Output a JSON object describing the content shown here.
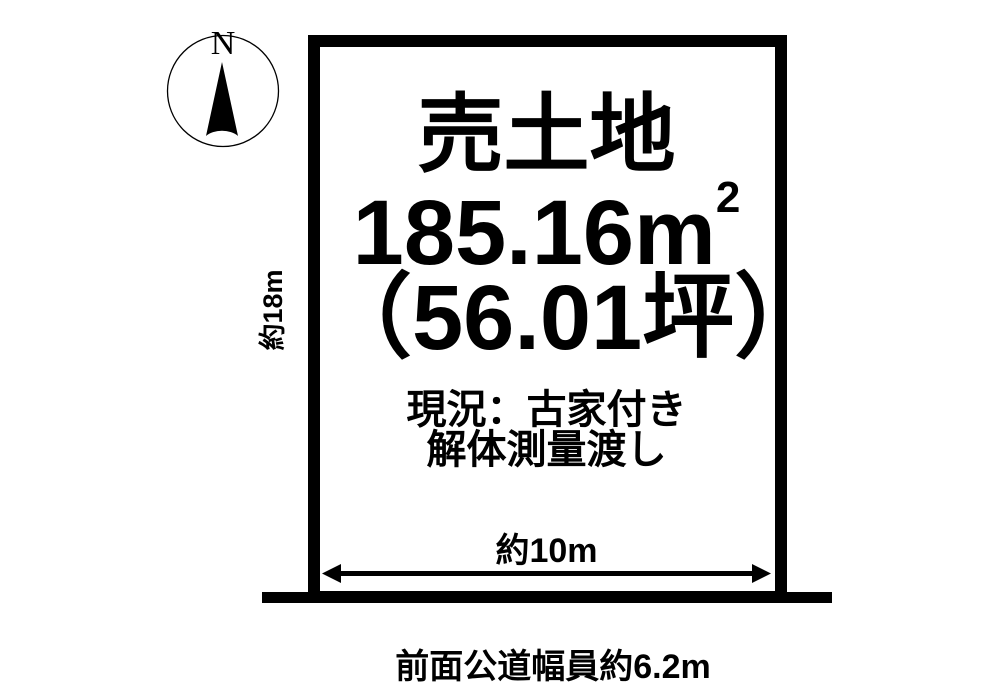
{
  "compass": {
    "north_label": "N"
  },
  "plot": {
    "title": "売土地",
    "area_m2": {
      "value": "185.16",
      "unit_base": "m",
      "unit_exponent": "2"
    },
    "area_tsubo": "（56.01坪）",
    "condition_notes": [
      "現況：古家付き",
      "解体測量渡し"
    ],
    "frontage_label": "約10m",
    "depth_label": "約18m"
  },
  "road": {
    "caption": "前面公道幅員約6.2m"
  },
  "colors": {
    "ink": "#000000",
    "background": "#ffffff"
  }
}
